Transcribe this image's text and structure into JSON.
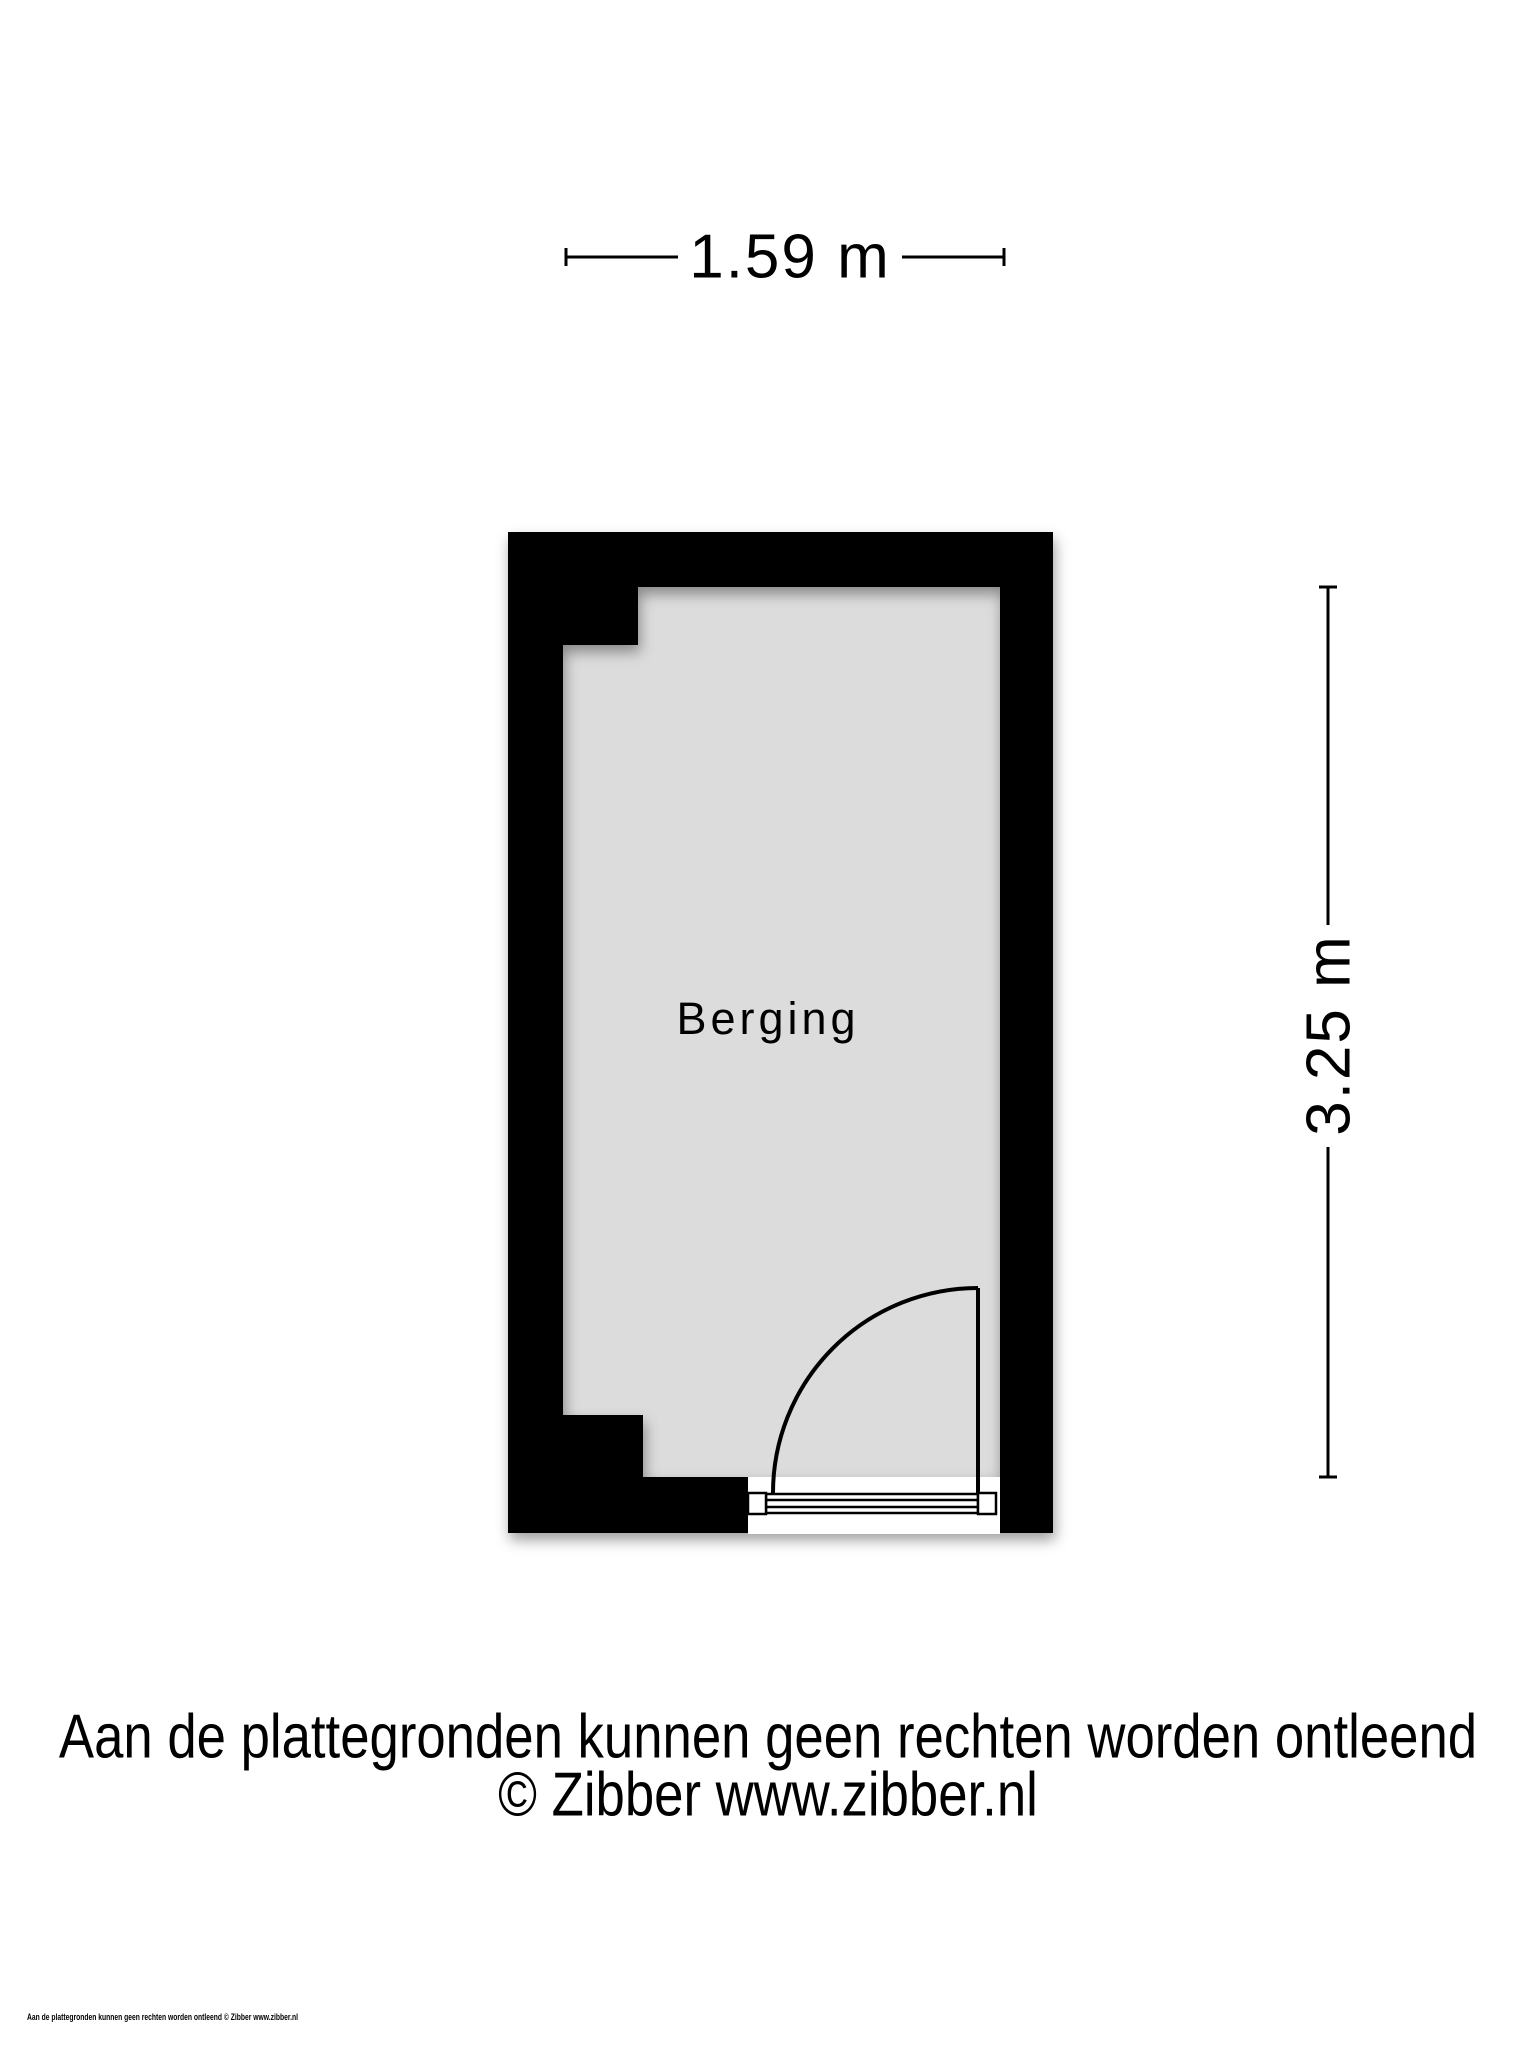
{
  "floorplan": {
    "room_label": "Berging",
    "dimensions": {
      "width_label": "1.59 m",
      "height_label": "3.25 m"
    },
    "colors": {
      "wall": "#000000",
      "floor": "#dcdcdc",
      "line": "#000000",
      "page-bg": "#ffffff"
    }
  },
  "footer": {
    "disclaimer_line1": "Aan de plattegronden kunnen geen rechten worden ontleend",
    "disclaimer_line2": "© Zibber www.zibber.nl",
    "fine_print": "Aan de plattegronden kunnen geen rechten worden ontleend © Zibber www.zibber.nl"
  }
}
